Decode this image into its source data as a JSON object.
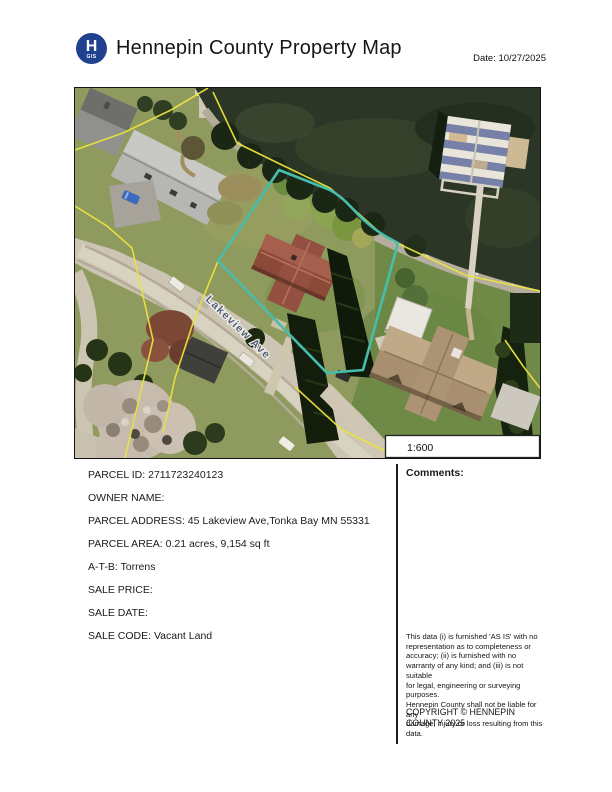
{
  "header": {
    "logo_letter": "H",
    "logo_sub": "GIS",
    "title": "Hennepin County Property Map",
    "date_label": "Date: 10/27/2025"
  },
  "map": {
    "street_label": "Lakeview Ave",
    "scale_label": "1:600"
  },
  "parcel": {
    "rows": [
      "PARCEL ID: 2711723240123",
      "OWNER NAME:",
      "PARCEL ADDRESS: 45 Lakeview Ave,Tonka Bay MN 55331",
      "PARCEL AREA: 0.21 acres, 9,154 sq ft",
      "A-T-B: Torrens",
      "SALE PRICE:",
      "SALE DATE:",
      "SALE CODE: Vacant Land"
    ]
  },
  "comments": {
    "label": "Comments:"
  },
  "disclaimer": {
    "text": "This data (i) is furnished 'AS IS' with no\nrepresentation as to completeness or\naccuracy; (ii) is furnished with no\nwarranty of any kind; and (iii) is not suitable\nfor legal, engineering or surveying purposes.\nHennepin County shall not be liable for any\ndamage, injury or loss resulting from this data."
  },
  "copyright": {
    "text": "COPYRIGHT © HENNEPIN\nCOUNTY  2025"
  },
  "colors": {
    "logo_blue": "#20418f",
    "parcel_highlight": "#47bdac",
    "lot_lines": "#eae33e"
  }
}
